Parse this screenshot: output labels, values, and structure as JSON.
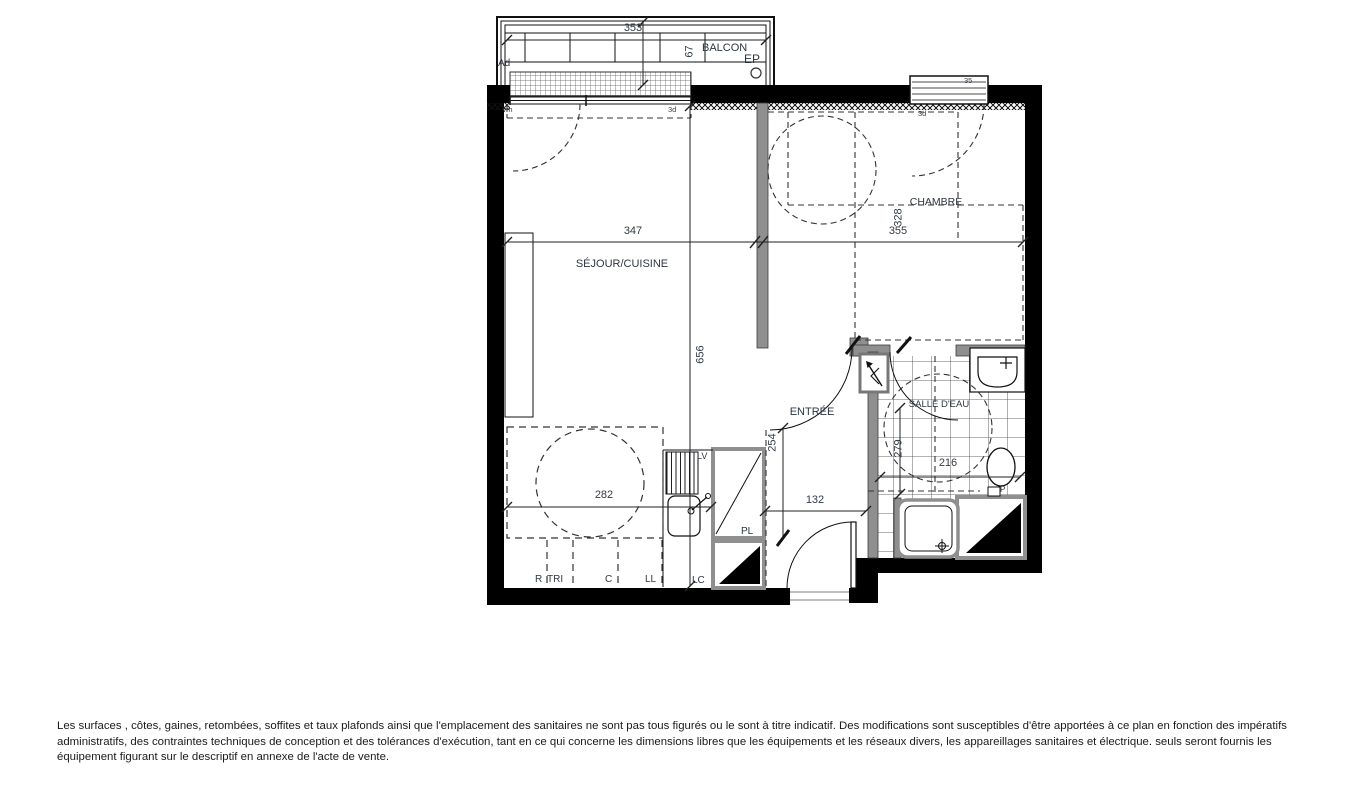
{
  "colors": {
    "wall": "#000000",
    "partition": "#8f8f8f",
    "line": "#222222",
    "text": "#2e3640"
  },
  "plan": {
    "room_labels": {
      "balcony": "BALCON",
      "living_kitchen": "SÉJOUR/CUISINE",
      "bedroom": "CHAMBRE",
      "entry": "ENTRÉE",
      "bathroom": "SALLE D'EAU"
    },
    "dimensions": {
      "balcony_width": "353",
      "balcony_depth": "67",
      "living_width": "347",
      "living_length": "656",
      "bedroom_width": "355",
      "bedroom_depth": "328",
      "kitchen_width": "282",
      "entry_length": "254",
      "entry_width": "132",
      "bathroom_length": "279",
      "bathroom_width": "216"
    },
    "annotations": {
      "ad": "Ad",
      "ep": "EP",
      "window_code": "35",
      "code_left": "wh",
      "code_right": "3d",
      "bedroom_code": "3d",
      "dishwasher": "LV",
      "closet": "PL",
      "duct": "LC",
      "fridge": "R",
      "recycling": "TRI",
      "cooktop": "C",
      "washing_machine": "LL",
      "wc": "P"
    }
  },
  "footer": {
    "disclaimer": "Les surfaces , côtes, gaines, retombées, soffites et taux plafonds ainsi que l'emplacement des sanitaires ne sont pas tous figurés ou le sont à titre indicatif. Des modifications sont susceptibles d'être apportées à ce plan en fonction des impératifs administratifs, des contraintes techniques de conception et des tolérances d'exécution, tant en ce qui concerne les dimensions libres que les équipements et les réseaux divers, les appareillages sanitaires et électrique. seuls seront fournis les équipement figurant sur le descriptif en annexe de l'acte de vente."
  }
}
